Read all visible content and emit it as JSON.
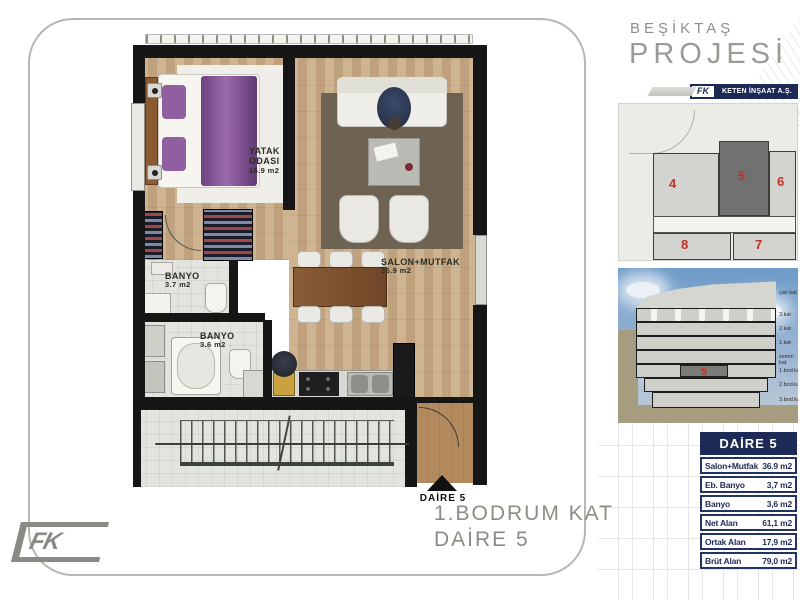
{
  "brand": {
    "project_line1": "BEŞİKTAŞ",
    "project_line2": "PROJESİ",
    "company_name": "KETEN İNŞAAT A.Ş.",
    "logo_text": "FK"
  },
  "caption": {
    "line1": "1.BODRUM KAT",
    "line2": "DAİRE 5"
  },
  "floor_plan": {
    "rooms": [
      {
        "name": "YATAK",
        "name2": "ODASI",
        "area": "16.9 m2"
      },
      {
        "name": "SALON+MUTFAK",
        "name2": "",
        "area": "36.9 m2"
      },
      {
        "name": "BANYO",
        "name2": "",
        "area": "3.7 m2"
      },
      {
        "name": "BANYO",
        "name2": "",
        "area": "3.6 m2"
      }
    ],
    "entrance_marker": "DAİRE 5"
  },
  "site_plan": {
    "units": [
      "4",
      "5",
      "6",
      "8",
      "7"
    ],
    "highlighted_unit": "5"
  },
  "section": {
    "floor_labels": [
      "çatı kat",
      "3.kat",
      "2.kat",
      "1.kat",
      "zemin kat",
      "1.bod.kat",
      "2.bod.kat",
      "3.bod.kat"
    ],
    "highlighted_unit": "5"
  },
  "unit_table": {
    "header": "DAİRE 5",
    "rows": [
      {
        "label": "Salon+Mutfak",
        "value": "36.9 m2"
      },
      {
        "label": "Eb. Banyo",
        "value": "3,7 m2"
      },
      {
        "label": "Banyo",
        "value": "3,6 m2"
      },
      {
        "label": "Net Alan",
        "value": "61,1 m2"
      },
      {
        "label": "Ortak Alan",
        "value": "17,9 m2"
      },
      {
        "label": "Brüt Alan",
        "value": "79,0 m2"
      }
    ]
  },
  "colors": {
    "navy": "#1d2a56",
    "red": "#c03126",
    "title_gray": "#8c8c85",
    "wood": "#c9ab84",
    "wall": "#161616"
  }
}
